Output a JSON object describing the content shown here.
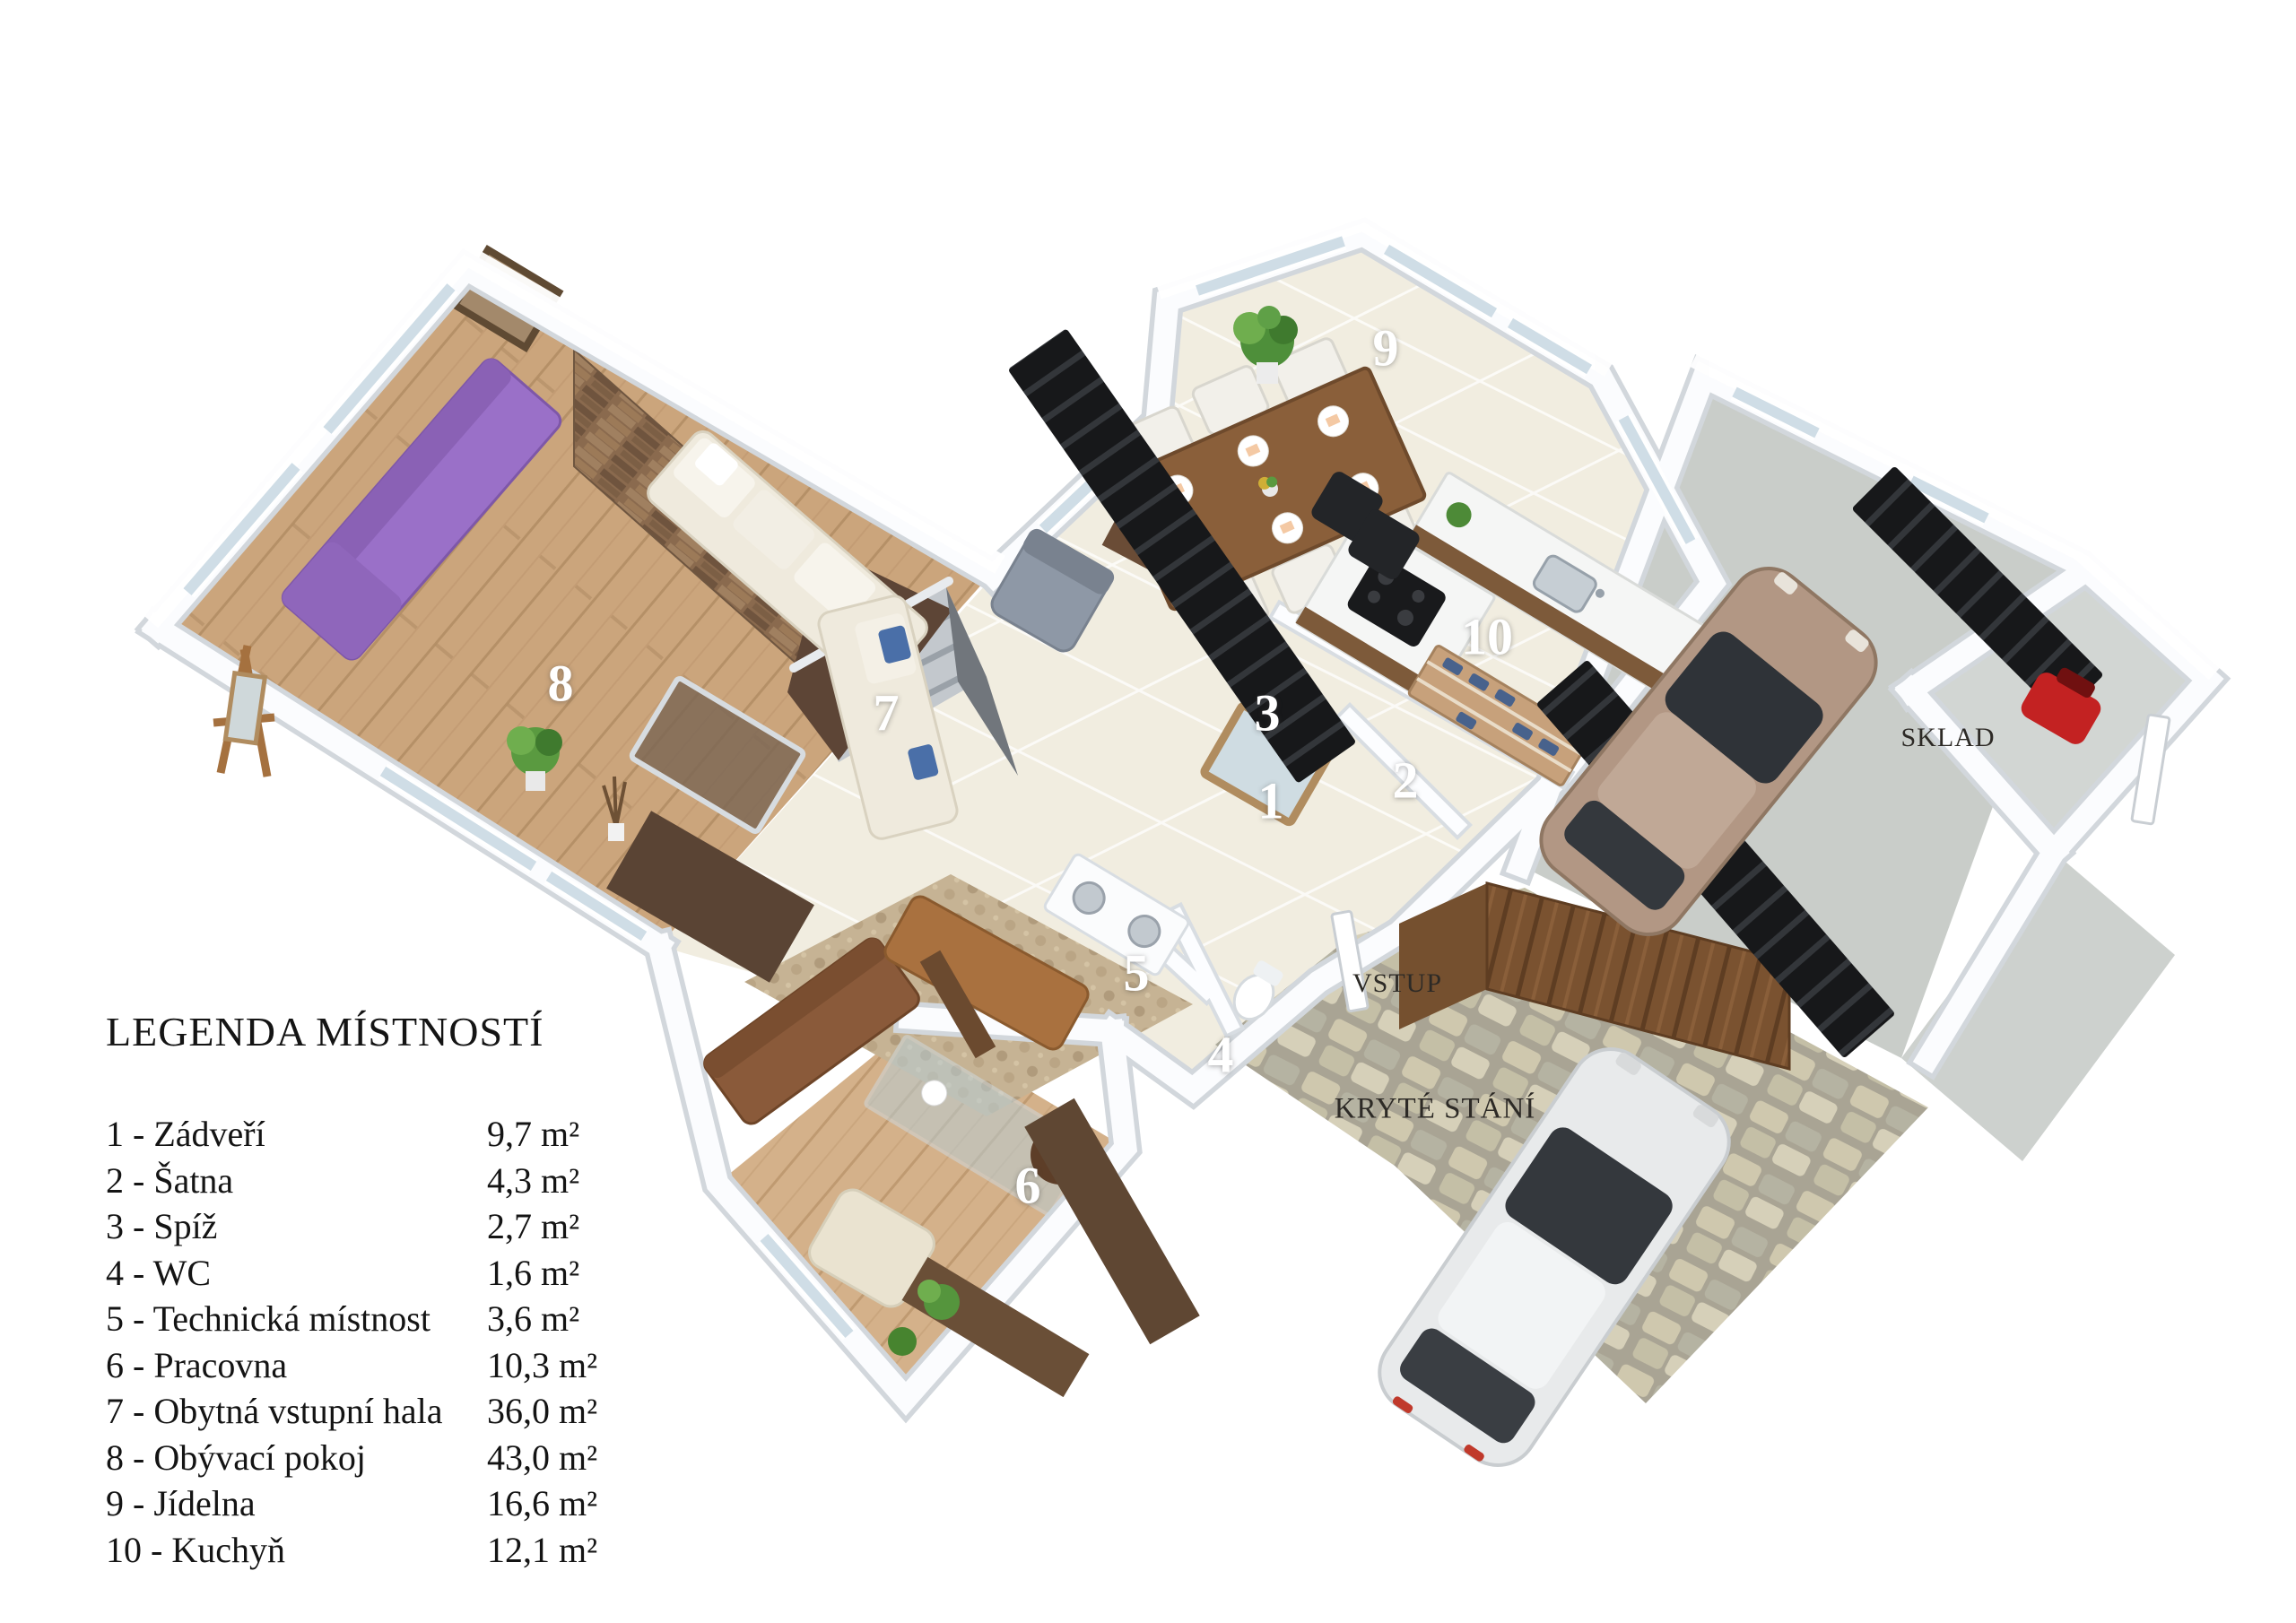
{
  "legend": {
    "title": "LEGENDA MÍSTNOSTÍ",
    "items": [
      {
        "label": "1 - Zádveří",
        "area": "9,7 m²"
      },
      {
        "label": "2 - Šatna",
        "area": "4,3 m²"
      },
      {
        "label": "3 - Spíž",
        "area": "2,7 m²"
      },
      {
        "label": "4 - WC",
        "area": "1,6 m²"
      },
      {
        "label": "5 - Technická místnost",
        "area": "3,6 m²"
      },
      {
        "label": "6 - Pracovna",
        "area": "10,3 m²"
      },
      {
        "label": "7 - Obytná vstupní hala",
        "area": "36,0 m²"
      },
      {
        "label": "8 - Obývací pokoj",
        "area": "43,0 m²"
      },
      {
        "label": "9 - Jídelna",
        "area": "16,6 m²"
      },
      {
        "label": "10 - Kuchyň",
        "area": "12,1 m²"
      }
    ]
  },
  "plan": {
    "room_numbers": [
      "1",
      "2",
      "3",
      "4",
      "5",
      "6",
      "7",
      "8",
      "9",
      "10"
    ],
    "zone_labels": {
      "entrance": "VSTUP",
      "covered_parking": "KRYTÉ STÁNÍ",
      "storage": "SKLAD"
    }
  },
  "colors": {
    "wood_floor": "#c9a478",
    "tile_floor": "#f1ede0",
    "stone_accent_wall": "#8a6a4e",
    "parking_stone": "#c2bca6",
    "garage_concrete": "#c9cdc9",
    "purple_sofa": "#9a70c8",
    "gate_wood": "#7a5230"
  }
}
